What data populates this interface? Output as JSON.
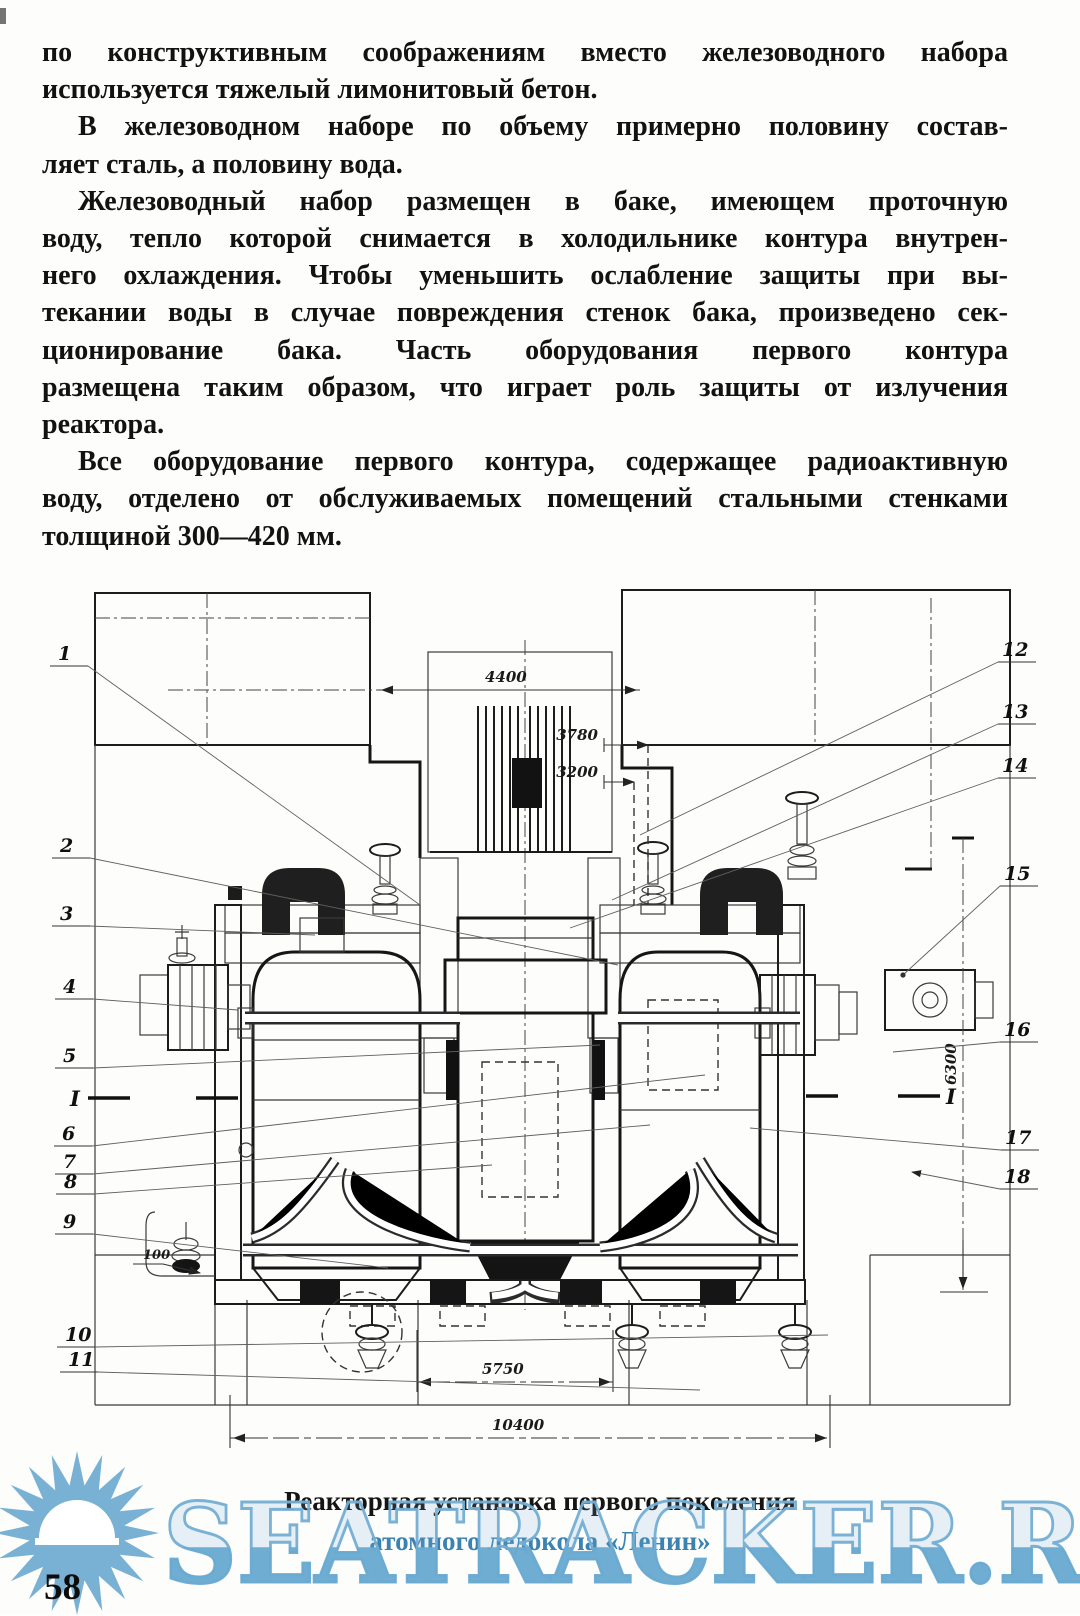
{
  "page": {
    "number": "58"
  },
  "article": {
    "lines": [
      {
        "t": "по конструктивным соображениям вместо железоводного набора"
      },
      {
        "t": "используется тяжелый лимонитовый бетон."
      },
      {
        "t": "В железоводном наборе по объему примерно половину состав-"
      },
      {
        "t": "ляет сталь, а половину вода."
      },
      {
        "t": "Железоводный набор размещен в баке, имеющем проточную"
      },
      {
        "t": "воду, тепло которой снимается в холодильнике контура внутрен-"
      },
      {
        "t": "него охлаждения. Чтобы уменьшить ослабление защиты при вы-"
      },
      {
        "t": "текании воды в случае повреждения стенок бака, произведено сек-"
      },
      {
        "t": "ционирование бака. Часть оборудования первого контура"
      },
      {
        "t": "размещена таким образом, что играет роль защиты от излучения"
      },
      {
        "t": "реактора."
      },
      {
        "t": "Все оборудование первого контура, содержащее радиоактивную"
      },
      {
        "t": "воду, отделено от обслуживаемых помещений стальными стенками"
      },
      {
        "t": "толщиной 300—420 мм."
      }
    ]
  },
  "figure": {
    "caption_line1": "Реакторная установка первого поколения",
    "caption_line2": "атомного ледокола «Ленин»",
    "section_mark": "I",
    "dimensions": {
      "top_width": "4400",
      "height_upper": "3780",
      "height_lower": "3200",
      "right_height": "6300",
      "bottom_inner": "5750",
      "bottom_outer": "10400",
      "small_offset": "100"
    },
    "callouts_left": [
      "1",
      "2",
      "3",
      "4",
      "5",
      "6",
      "7",
      "8",
      "9",
      "10",
      "11"
    ],
    "callouts_right": [
      "12",
      "13",
      "14",
      "15",
      "16",
      "17",
      "18"
    ]
  },
  "watermark": {
    "text": "SEATRACKER.RU",
    "color": "#6babd2"
  }
}
